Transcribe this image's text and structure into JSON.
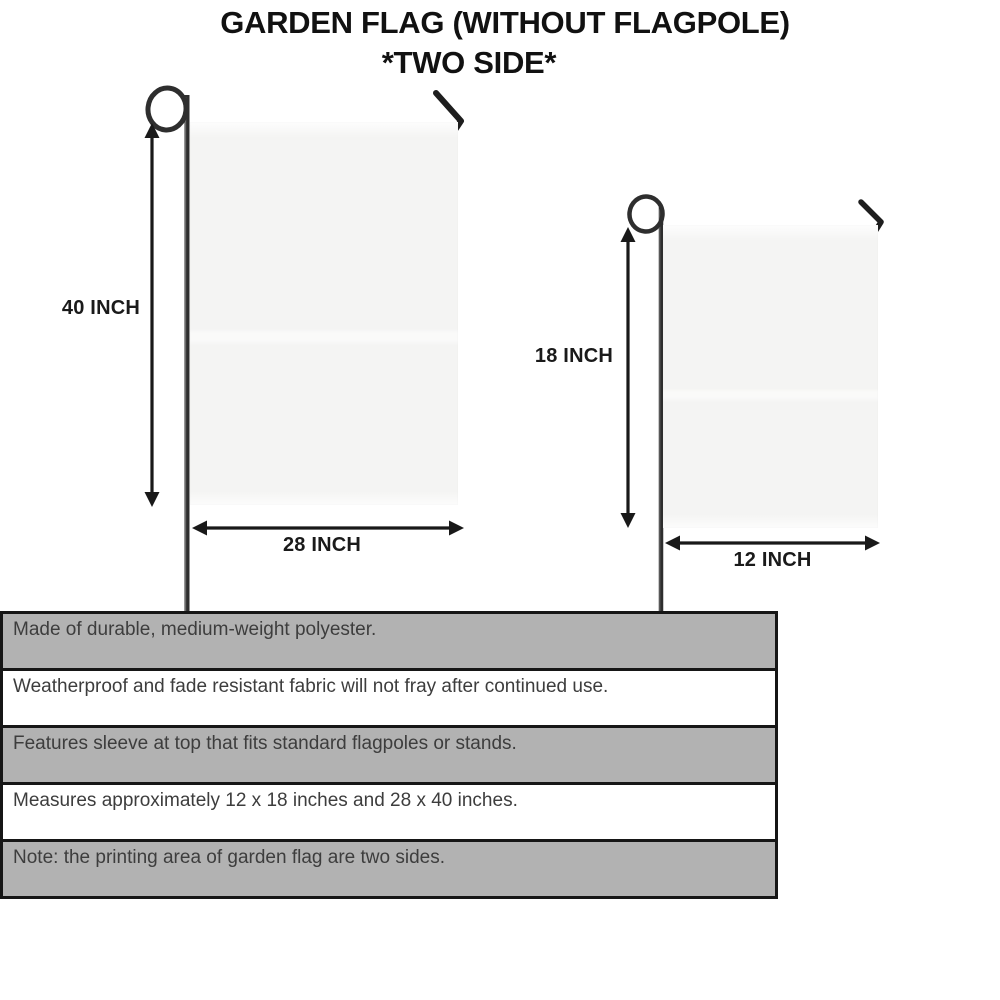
{
  "header": {
    "title_line1": "GARDEN FLAG (WITHOUT FLAGPOLE)",
    "title_line2": "*TWO SIDE*"
  },
  "diagram": {
    "large_flag": {
      "height_label": "40 INCH",
      "width_label": "28 INCH",
      "height_inches": 40,
      "width_inches": 28
    },
    "small_flag": {
      "height_label": "18 INCH",
      "width_label": "12 INCH",
      "height_inches": 18,
      "width_inches": 12
    }
  },
  "features": {
    "rows": [
      "Made of durable, medium-weight polyester.",
      "Weatherproof and fade resistant fabric will not fray after continued use.",
      "Features sleeve at top that fits standard flagpoles or stands.",
      "Measures approximately 12 x 18 inches and 28 x 40 inches.",
      "Note: the printing area of garden flag are two sides."
    ]
  },
  "colors": {
    "background": "#ffffff",
    "title_text": "#111111",
    "dimension_text": "#1a1a1a",
    "arrow": "#191919",
    "pole": "#2e2e2e",
    "flag_fill": "#f4f4f3",
    "table_border": "#161616",
    "table_row_gray": "#b2b2b2",
    "table_row_white": "#ffffff",
    "feature_text": "#3d3d3d"
  }
}
